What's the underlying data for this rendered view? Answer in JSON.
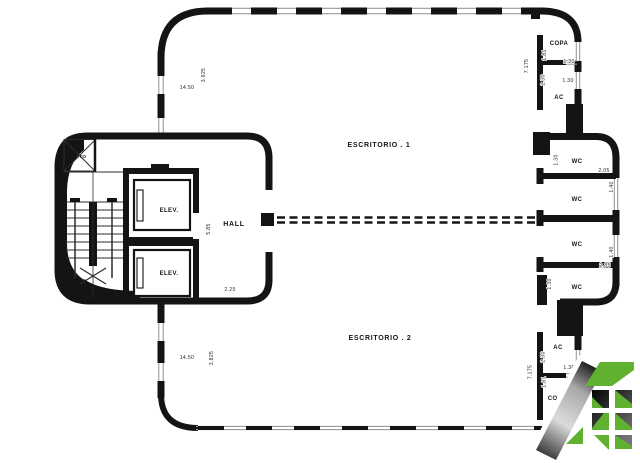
{
  "rooms": {
    "escritorio_1": "ESCRITORIO . 1",
    "escritorio_2": "ESCRITORIO . 2",
    "hall": "HALL",
    "elevator_1": "ELEV.",
    "elevator_2": "ELEV.",
    "duct": "DUTO",
    "copa_top": "COPA",
    "ac_top": "AC",
    "wc_1": "WC",
    "wc_2": "WC",
    "wc_3": "WC",
    "wc_4": "WC",
    "ac_bottom": "AC",
    "copa_bottom": "COPA"
  },
  "dims": {
    "top_width": "14.50",
    "top_height": "3.925",
    "hall_height": "5.85",
    "hall_depth": "2.25",
    "bottom_width": "14.50",
    "bottom_height": "3.825",
    "right_top_total": "7.175",
    "copa_top_depth": "1.81",
    "copa_top_window": "1.30",
    "ac_top_depth": "2.30",
    "ac_top_window": "1.30",
    "wc1_door": "1.30",
    "wc1_width": "2.05",
    "wc2_window": "1.40",
    "wc3_window": "1.40",
    "wc3_width": "2.85",
    "wc4_door": "1.30",
    "ac_bottom_depth": "2.30",
    "right_bottom_total": "7.175",
    "ac_bottom_window": "1.30",
    "copa_bottom_depth": "1.81"
  },
  "colors": {
    "wall": "#141414",
    "window": "#9b9b9b",
    "logo_green": "#61b130"
  }
}
